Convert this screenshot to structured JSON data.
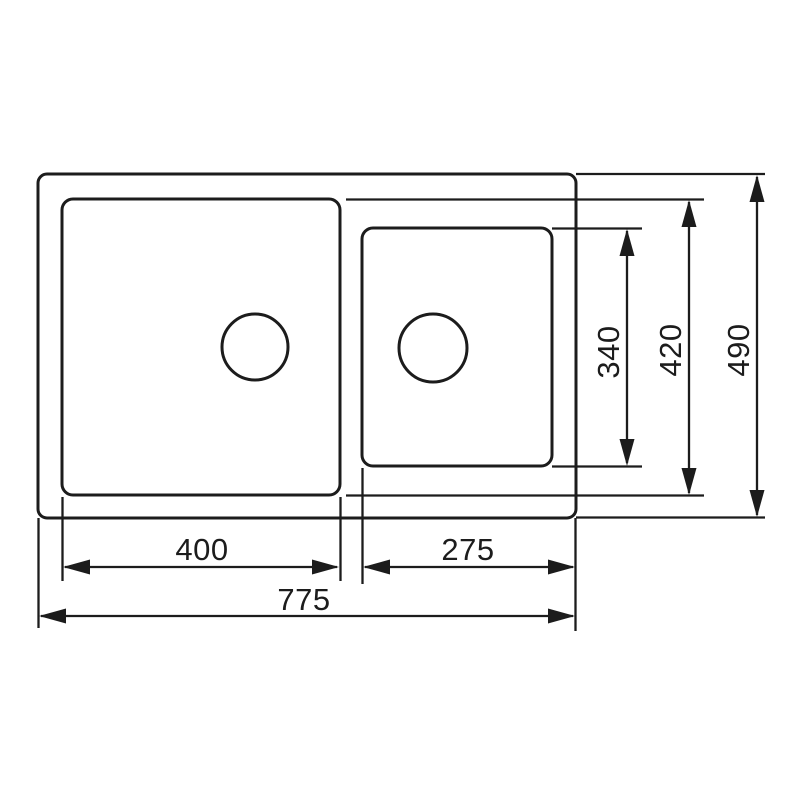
{
  "diagram": {
    "type": "technical-drawing",
    "subject": "double-bowl kitchen sink, top view with dimensions",
    "colors": {
      "background": "#ffffff",
      "line": "#1c1c1c",
      "text": "#1c1c1c"
    },
    "dimensions": {
      "left_bowl_width": "400",
      "right_bowl_width": "275",
      "overall_width": "775",
      "right_bowl_depth": "340",
      "bowl_depth": "420",
      "overall_depth": "490"
    }
  }
}
